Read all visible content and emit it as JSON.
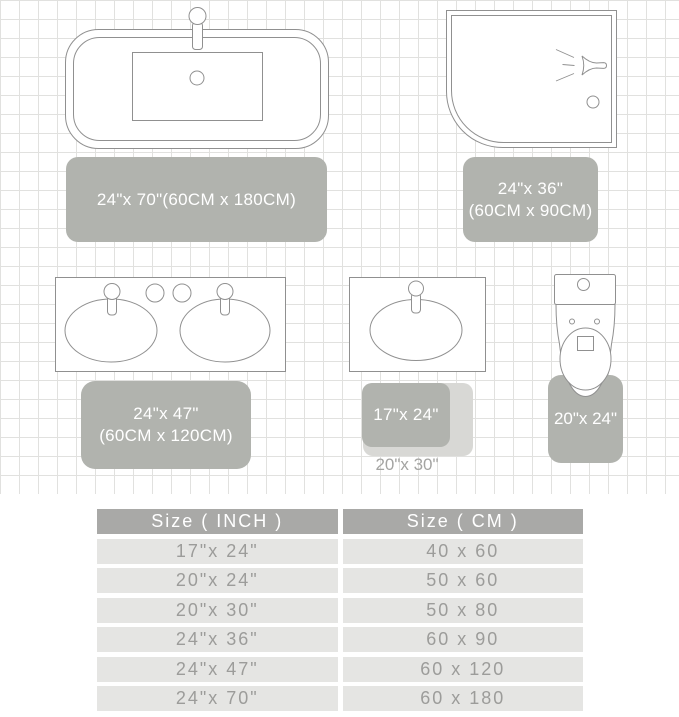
{
  "figure": {
    "bathtub": {
      "rug_label": "24\"x 70\"(60CM x 180CM)"
    },
    "shower": {
      "rug_line1": "24\"x 36\"",
      "rug_line2": "(60CM x 90CM)"
    },
    "double_vanity": {
      "rug_line1": "24\"x 47\"",
      "rug_line2": "(60CM x 120CM)"
    },
    "single_sink": {
      "dark_rug_label": "17\"x 24\"",
      "light_rug_label": "20\"x 30\""
    },
    "toilet": {
      "rug_label": "20\"x 24\""
    }
  },
  "table": {
    "headers": [
      "Size ( INCH )",
      "Size ( CM )"
    ],
    "rows": [
      {
        "inch": "17\"x 24\"",
        "cm": "40 x 60"
      },
      {
        "inch": "20\"x 24\"",
        "cm": "50 x 60"
      },
      {
        "inch": "20\"x 30\"",
        "cm": "50 x 80"
      },
      {
        "inch": "24\"x 36\"",
        "cm": "60 x 90"
      },
      {
        "inch": "24\"x 47\"",
        "cm": "60 x 120"
      },
      {
        "inch": "24\"x 70\"",
        "cm": "60 x 180"
      }
    ]
  },
  "colors": {
    "rug": "#b1b3ae",
    "rug_light": "#d8d8d5",
    "rug_text": "#ffffff",
    "outside_label_text": "#a4a4a2",
    "table_header_bg": "#a9a9a7",
    "table_header_text": "#ffffff",
    "table_row_bg": "#e5e5e3",
    "table_row_text": "#9c9c9a",
    "fixture_outline": "#909090",
    "grid_line": "#e1e1df"
  }
}
